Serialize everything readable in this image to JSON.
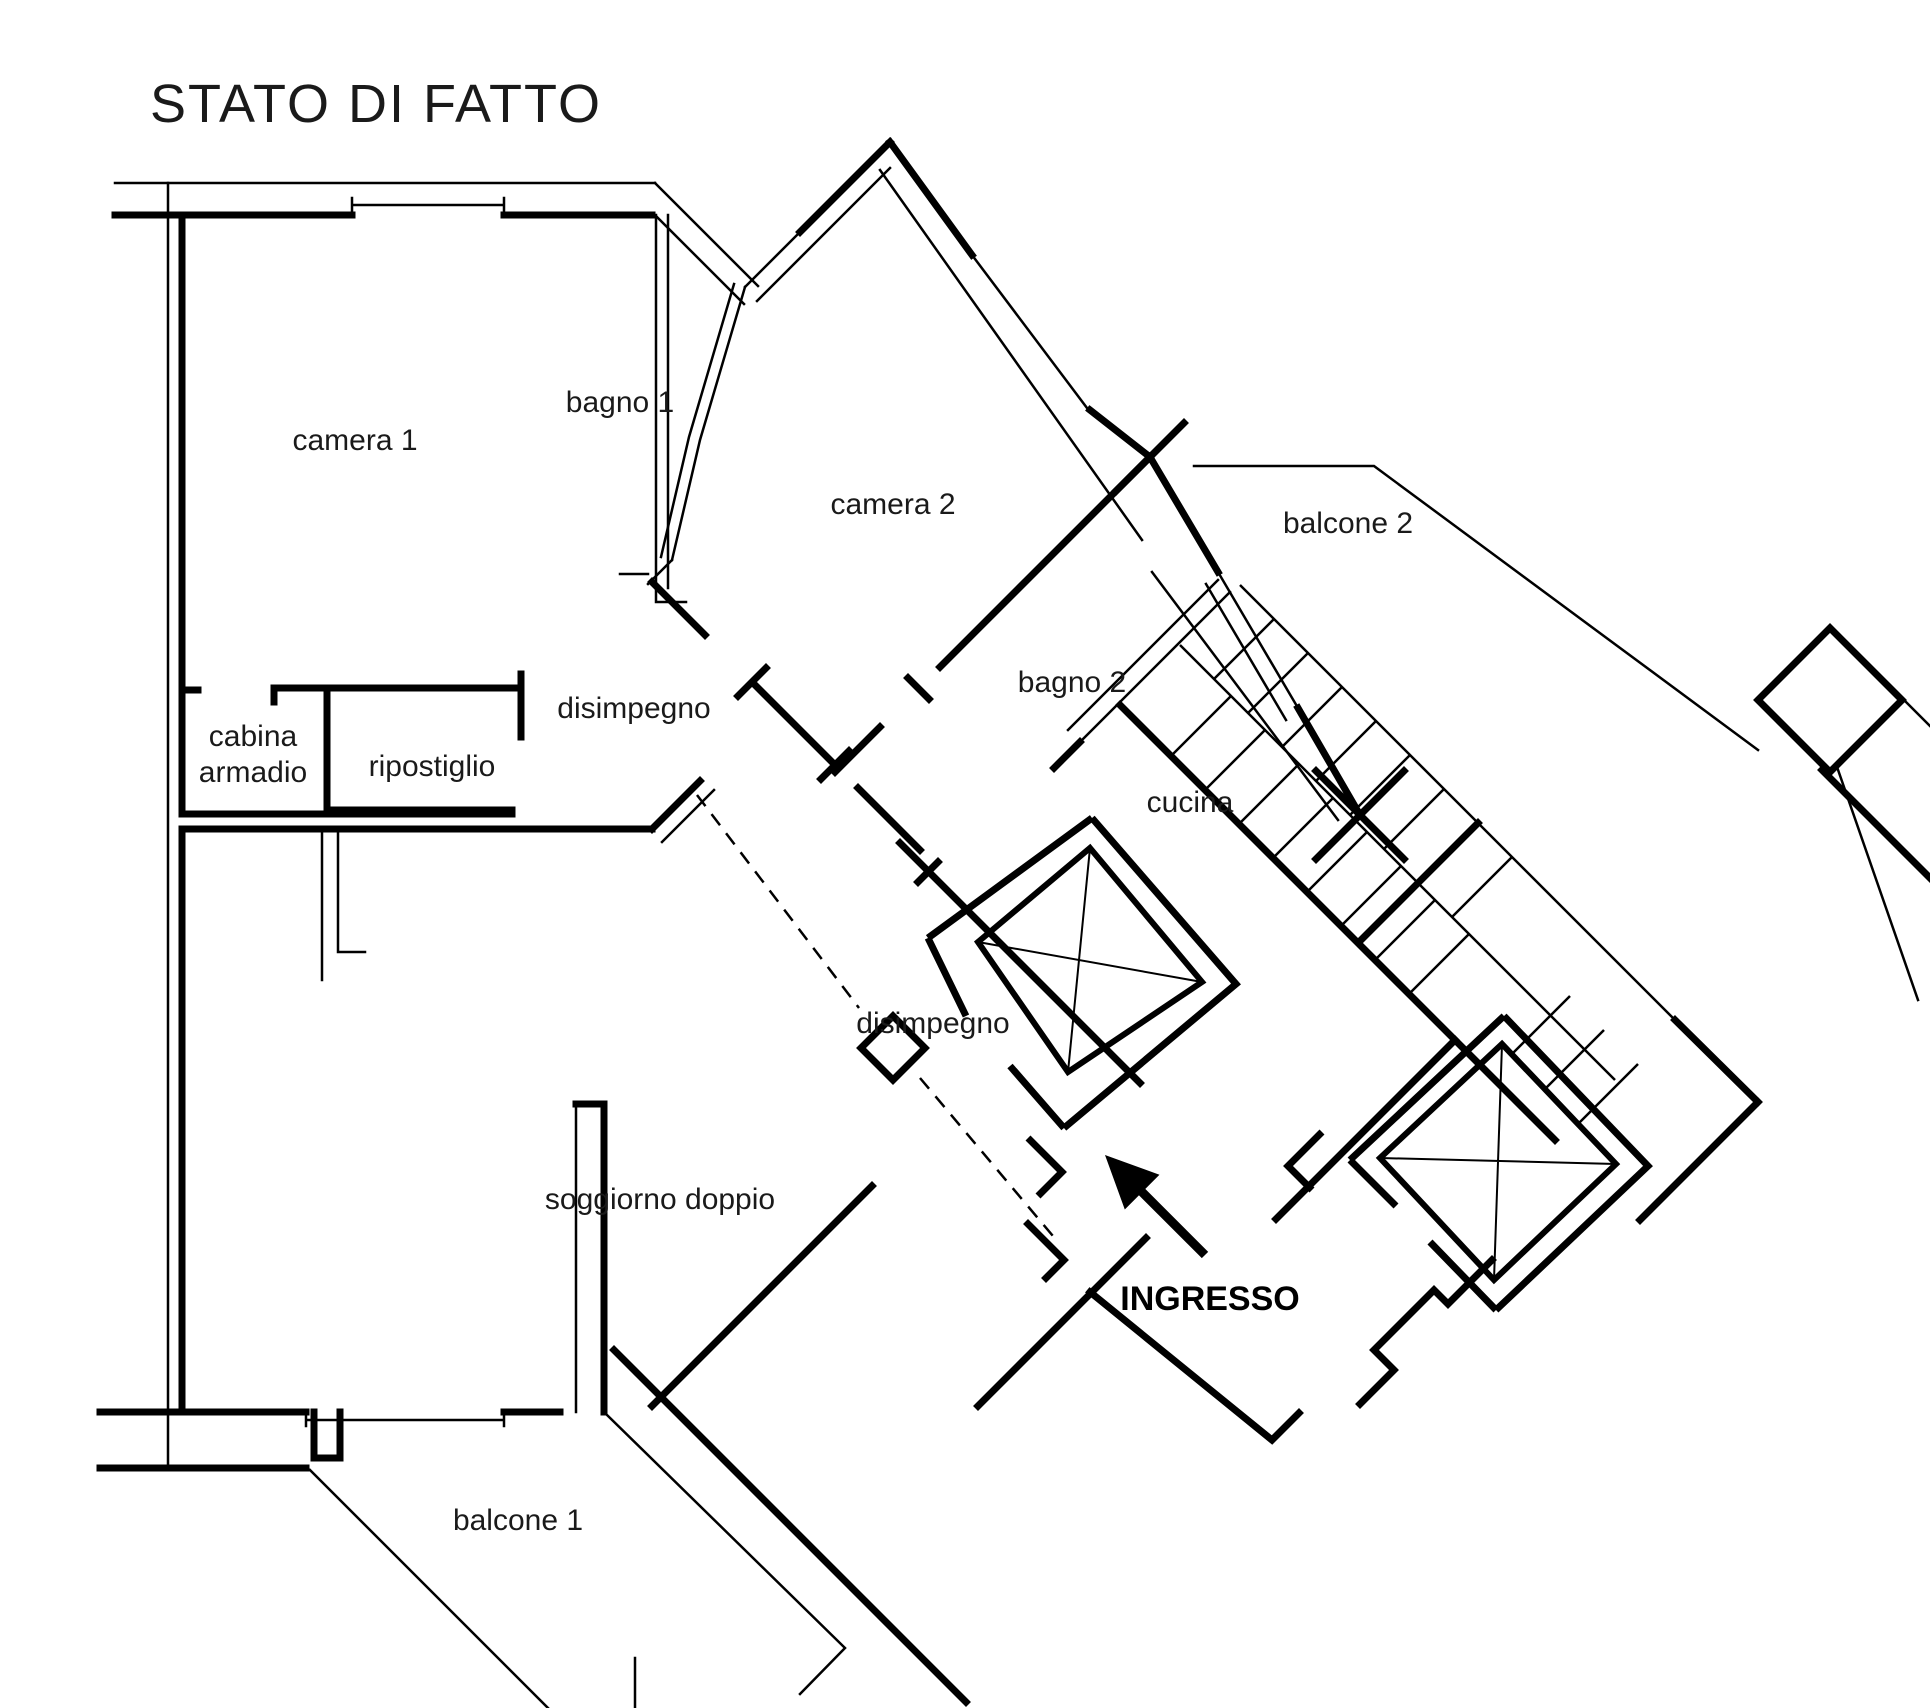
{
  "title": "STATO DI FATTO",
  "colors": {
    "wall": "#000000",
    "background": "#ffffff",
    "text": "#1a1a1a"
  },
  "rooms": {
    "camera1": "camera 1",
    "bagno1": "bagno 1",
    "camera2": "camera  2",
    "balcone2": "balcone 2",
    "bagno2": "bagno 2",
    "disimpegno_upper": "disimpegno",
    "cabina_line1": "cabina",
    "cabina_line2": "armadio",
    "ripostiglio": "ripostiglio",
    "cucina": "cucina",
    "disimpegno_lower": "disimpegno",
    "soggiorno": "soggiorno doppio",
    "balcone1": "balcone 1"
  },
  "entrance": {
    "label": "INGRESSO",
    "arrow_icon": "arrow-up-left"
  }
}
